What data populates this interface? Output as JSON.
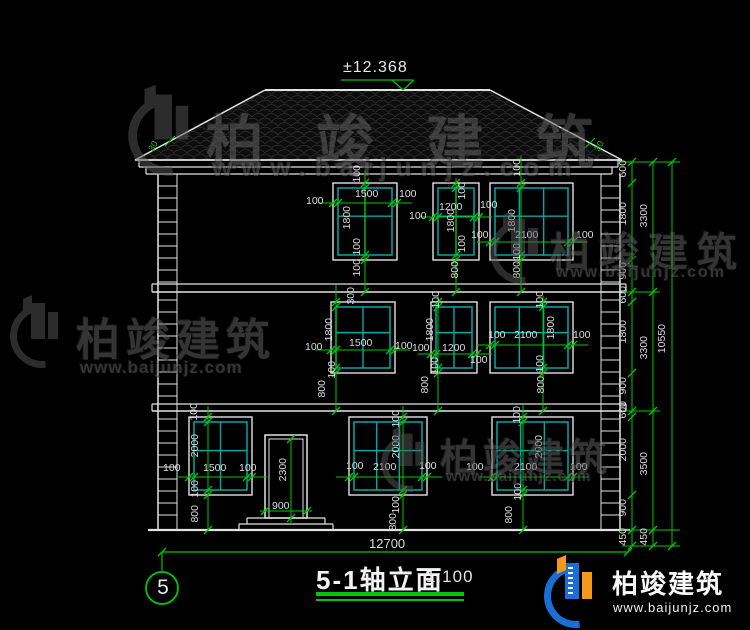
{
  "drawing": {
    "elevation_mark": "±12.368",
    "roof_slope_left": "30",
    "roof_slope_right": "30",
    "axis_bubble": "5",
    "title": "5-1轴立面",
    "scale": "1:100",
    "total_width": "12700"
  },
  "brand": {
    "name": "柏竣建筑",
    "url": "www.baijunjz.com"
  },
  "dims": {
    "right_col1": [
      "600",
      "1800",
      "900",
      "600",
      "1800",
      "900",
      "600",
      "2000",
      "900",
      "450"
    ],
    "right_col2": [
      "3300",
      "3300",
      "3500",
      "450"
    ],
    "right_col3": [
      "10550"
    ],
    "f3w1": {
      "top": "100",
      "width": "1500",
      "left": "100",
      "right": "100",
      "height": "1800",
      "bottom": "100",
      "bottom2": "100"
    },
    "f3w2": {
      "top": "100",
      "width": "1200",
      "left": "100",
      "right": "100",
      "height": "1800",
      "bottom": "100",
      "sill": "800"
    },
    "f3w3": {
      "top": "100",
      "width": "2100",
      "left": "100",
      "right": "100",
      "height": "1800",
      "bottom": "100",
      "sill": "800"
    },
    "f2w1": {
      "top": "300",
      "width": "1500",
      "left": "100",
      "right": "100",
      "height": "1800",
      "bottom": "100",
      "sill": "800"
    },
    "f2w2": {
      "top": "100",
      "width": "1200",
      "left": "100",
      "right": "100",
      "height": "1800",
      "bottom": "100",
      "sill": "800"
    },
    "f2w3": {
      "top": "100",
      "width": "2100",
      "left": "100",
      "right": "100",
      "height": "1800",
      "bottom": "100",
      "sill": "800"
    },
    "f1w1": {
      "top": "100",
      "width": "1500",
      "left": "100",
      "right": "100",
      "height": "2000",
      "bottom": "100",
      "sill": "800"
    },
    "f1w2": {
      "top": "100",
      "width": "2100",
      "left": "100",
      "right": "100",
      "height": "2000",
      "bottom": "100",
      "sill": "800"
    },
    "f1w3": {
      "top": "100",
      "width": "2100",
      "left": "100",
      "right": "100",
      "height": "2000",
      "bottom": "100",
      "sill": "800"
    },
    "door": {
      "width": "900",
      "height": "2300"
    }
  },
  "colors": {
    "dim_green": "#00c800",
    "window_teal": "#00a8a8",
    "line_white": "#e2e2e2",
    "brand_blue": "#1a6fd4",
    "brand_orange": "#f5991d"
  }
}
